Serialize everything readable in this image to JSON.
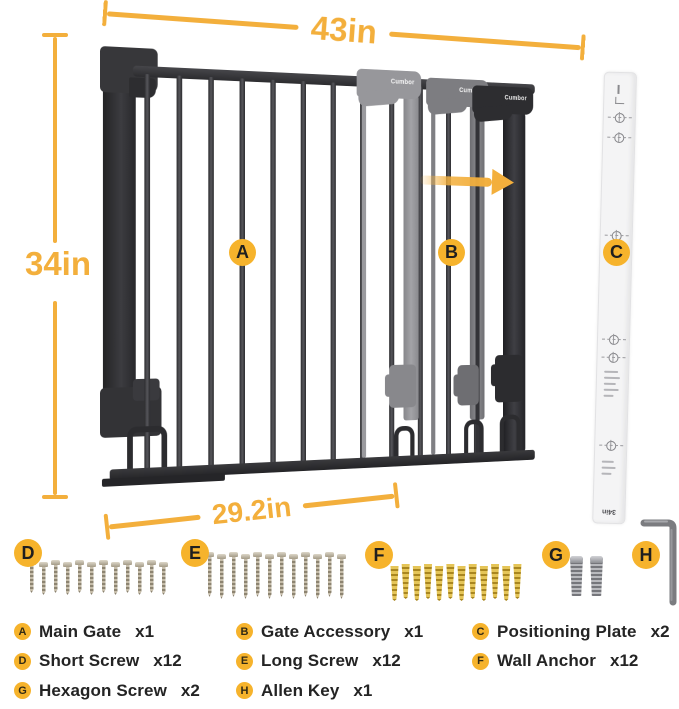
{
  "brand": "Cumbor",
  "dimensions": {
    "overall_width": "43in",
    "overall_height": "34in",
    "gate_width": "29.2in"
  },
  "plate_print": "34in",
  "colors": {
    "accent_yellow": "#F3AF3C",
    "badge_yellow": "#F6B32C",
    "gate_dark": "#333336",
    "ghost_light": "#97979B",
    "ghost_mid": "#7D7D81",
    "plate_white": "#F4F4F5",
    "anchor_gold": "#D8B23C",
    "screw_metal": "#B3A992"
  },
  "callouts": {
    "main_gate": "A",
    "gate_accessory": "B",
    "positioning_plate": "C",
    "short_screw": "D",
    "long_screw": "E",
    "wall_anchor": "F",
    "hexagon_screw": "G",
    "allen_key": "H"
  },
  "hardware_counts": {
    "short_screw": 12,
    "long_screw": 12,
    "wall_anchor": 12,
    "hexagon_screw": 2,
    "allen_key": 1
  },
  "parts_list": [
    {
      "badge": "A",
      "name": "Main Gate",
      "qty": "x1"
    },
    {
      "badge": "B",
      "name": "Gate Accessory",
      "qty": "x1"
    },
    {
      "badge": "C",
      "name": "Positioning Plate",
      "qty": "x2"
    },
    {
      "badge": "D",
      "name": "Short Screw",
      "qty": "x12"
    },
    {
      "badge": "E",
      "name": "Long Screw",
      "qty": "x12"
    },
    {
      "badge": "F",
      "name": "Wall Anchor",
      "qty": "x12"
    },
    {
      "badge": "G",
      "name": "Hexagon Screw",
      "qty": "x2"
    },
    {
      "badge": "H",
      "name": "Allen Key",
      "qty": "x1"
    }
  ]
}
